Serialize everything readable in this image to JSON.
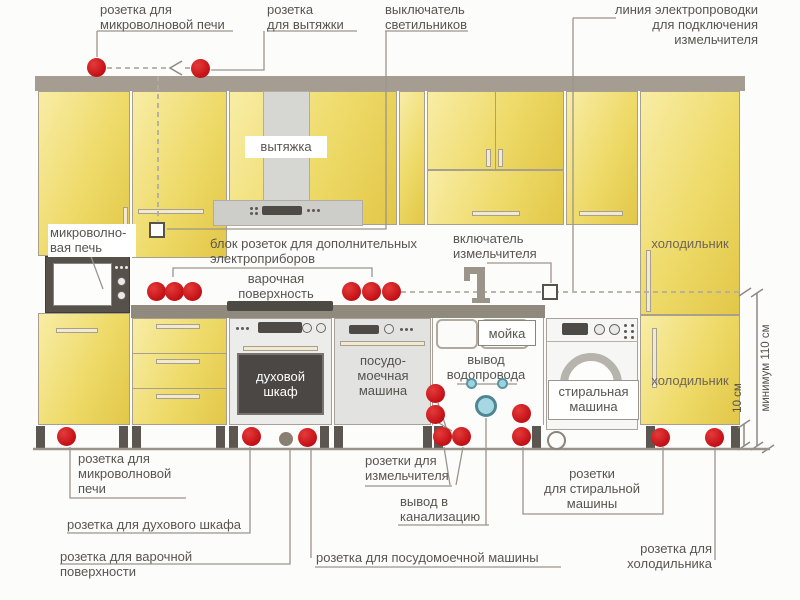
{
  "colors": {
    "socket_red": "#ce1419",
    "special_socket_grey": "#8a7f73",
    "water_blue": "#a5d8e2",
    "cabinet_yellow": "#ecd75e",
    "wall_grey": "#a59d92",
    "leader_line_grey": "#9b958b"
  },
  "top": {
    "mw_socket": [
      "розетка для",
      "микроволновой печи"
    ],
    "hood_socket": [
      "розетка",
      "для вытяжки"
    ],
    "light_switch": [
      "выключатель",
      "светильников"
    ],
    "grinder_line": [
      "линия электропроводки",
      "для подключения",
      "измельчителя"
    ]
  },
  "middle": {
    "microwave": [
      "микроволно-",
      "вая печь"
    ],
    "hood": "вытяжка",
    "socket_block": [
      "блок розеток для дополнительных",
      "электроприборов"
    ],
    "cooktop": [
      "варочная",
      "поверхность"
    ],
    "grinder_switch": [
      "включатель",
      "измельчителя"
    ],
    "fridge_upper": "холодильник",
    "sink": "мойка",
    "water_outlet": [
      "вывод",
      "водопровода"
    ],
    "oven": [
      "духовой",
      "шкаф"
    ],
    "dishwasher": [
      "посудо-",
      "моечная",
      "машина"
    ],
    "washer": [
      "стиральная",
      "машина"
    ],
    "fridge_lower": "холодильник"
  },
  "bottom": {
    "mw_socket": [
      "розетка для",
      "микроволновой",
      "печи"
    ],
    "oven_socket": "розетка для духового шкафа",
    "cooktop_socket": [
      "розетка для варочной",
      "поверхности"
    ],
    "grinder_sockets": [
      "розетки для",
      "измельчителя"
    ],
    "sewer_outlet": [
      "вывод в",
      "канализацию"
    ],
    "dw_socket": "розетка для посудомоечной машины",
    "washer_sockets": [
      "розетки",
      "для стиральной",
      "машины"
    ],
    "fridge_socket": [
      "розетка для",
      "холодильника"
    ]
  },
  "dimensions": {
    "socket_height": "10 см",
    "line_height": "минимум 110 см"
  },
  "icons": {
    "faucet": "faucet-icon",
    "sewer_drain": "sewer-drain-icon",
    "arrow_left": "arrow-left-icon"
  }
}
